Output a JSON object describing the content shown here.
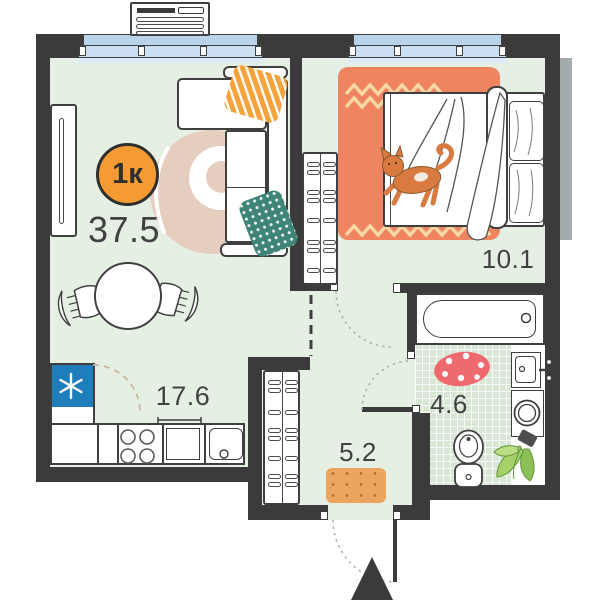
{
  "plan": {
    "badge_label": "1к",
    "total_area": "37.5",
    "rooms": {
      "living_kitchen": {
        "area": "17.6"
      },
      "bedroom": {
        "area": "10.1"
      },
      "hallway": {
        "area": "5.2"
      },
      "bathroom": {
        "area": "4.6"
      }
    },
    "colors": {
      "wall": "#3b3b3b",
      "accent_orange": "#f49b33",
      "floor_green": "#e5efe4",
      "tile_green": "#d8e7d4",
      "window_blue": "#cadff2",
      "fridge_blue": "#1f7dbb",
      "bedroom_rug_coral": "#ee8560",
      "bath_rug_red": "#ef6a6e",
      "pillow_teal": "#3f8577",
      "pillow_orange": "#f5a33c",
      "doormat_orange": "#eba55f",
      "living_rug_beige": "#e6cebf"
    },
    "icons": {
      "fridge": "snowflake-icon",
      "entrance": "entrance-arrow-icon"
    }
  }
}
